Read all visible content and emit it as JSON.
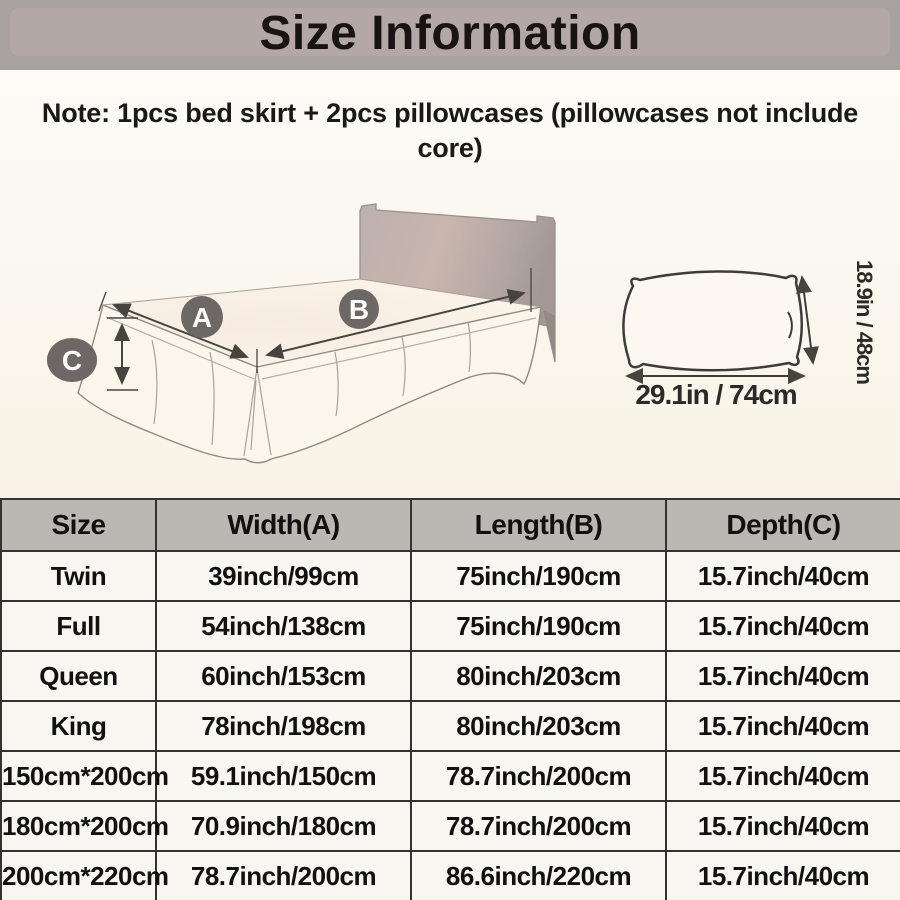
{
  "banner": {
    "title": "Size Information",
    "bg_outer": "#a7a2a0",
    "bg_inner": "#b3a8a5"
  },
  "note": {
    "text": "Note: 1pcs bed skirt + 2pcs pillowcases (pillowcases not include core)"
  },
  "bed_diagram": {
    "label_a": "A",
    "label_b": "B",
    "label_c": "C",
    "circle_color": "#6d6866",
    "skirt_color": "#fbf6eb",
    "headboard_color": "#b5aaa5"
  },
  "pillow_diagram": {
    "width_label": "29.1in / 74cm",
    "height_label": "18.9in / 48cm"
  },
  "size_table": {
    "headers": [
      "Size",
      "Width(A)",
      "Length(B)",
      "Depth(C)"
    ],
    "header_bg": "#bbb7b3",
    "rows": [
      [
        "Twin",
        "39inch/99cm",
        "75inch/190cm",
        "15.7inch/40cm"
      ],
      [
        "Full",
        "54inch/138cm",
        "75inch/190cm",
        "15.7inch/40cm"
      ],
      [
        "Queen",
        "60inch/153cm",
        "80inch/203cm",
        "15.7inch/40cm"
      ],
      [
        "King",
        "78inch/198cm",
        "80inch/203cm",
        "15.7inch/40cm"
      ],
      [
        "150cm*200cm",
        "59.1inch/150cm",
        "78.7inch/200cm",
        "15.7inch/40cm"
      ],
      [
        "180cm*200cm",
        "70.9inch/180cm",
        "78.7inch/200cm",
        "15.7inch/40cm"
      ],
      [
        "200cm*220cm",
        "78.7inch/200cm",
        "86.6inch/220cm",
        "15.7inch/40cm"
      ]
    ]
  }
}
